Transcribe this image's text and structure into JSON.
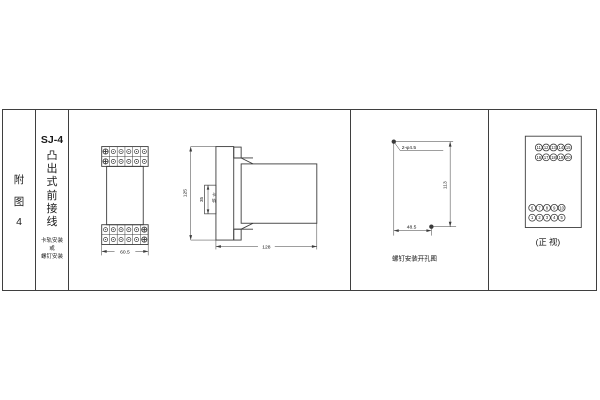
{
  "page": {
    "background": "#ffffff",
    "line_color": "#3a3a3a"
  },
  "index_column": {
    "chars": [
      "附",
      "图",
      "4"
    ]
  },
  "title_column": {
    "model": "SJ-4",
    "chars": [
      "凸",
      "出",
      "式",
      "前",
      "接",
      "线"
    ],
    "mount_lines": [
      "卡轨安装",
      "或",
      "螺钉安装"
    ]
  },
  "outline_views": {
    "front_width_dim": "60.5",
    "side_height_dim": "125",
    "rail_width_dim": "35",
    "rail_label_chars": [
      "卡",
      "轨"
    ],
    "side_depth_dim": "128"
  },
  "drilling_view": {
    "holes_label": "2-φ4.5",
    "height_dim": "113",
    "width_dim": "48.5",
    "caption": "螺钉安装开孔图"
  },
  "front_view": {
    "caption": "(正 视)",
    "terminal_rows": {
      "top": [
        [
          "11",
          "12",
          "13",
          "14",
          "15"
        ],
        [
          "16",
          "17",
          "18",
          "19",
          "20"
        ]
      ],
      "bottom": [
        [
          "6",
          "7",
          "8",
          "9",
          "10"
        ],
        [
          "1",
          "2",
          "3",
          "4",
          "5"
        ]
      ]
    }
  }
}
